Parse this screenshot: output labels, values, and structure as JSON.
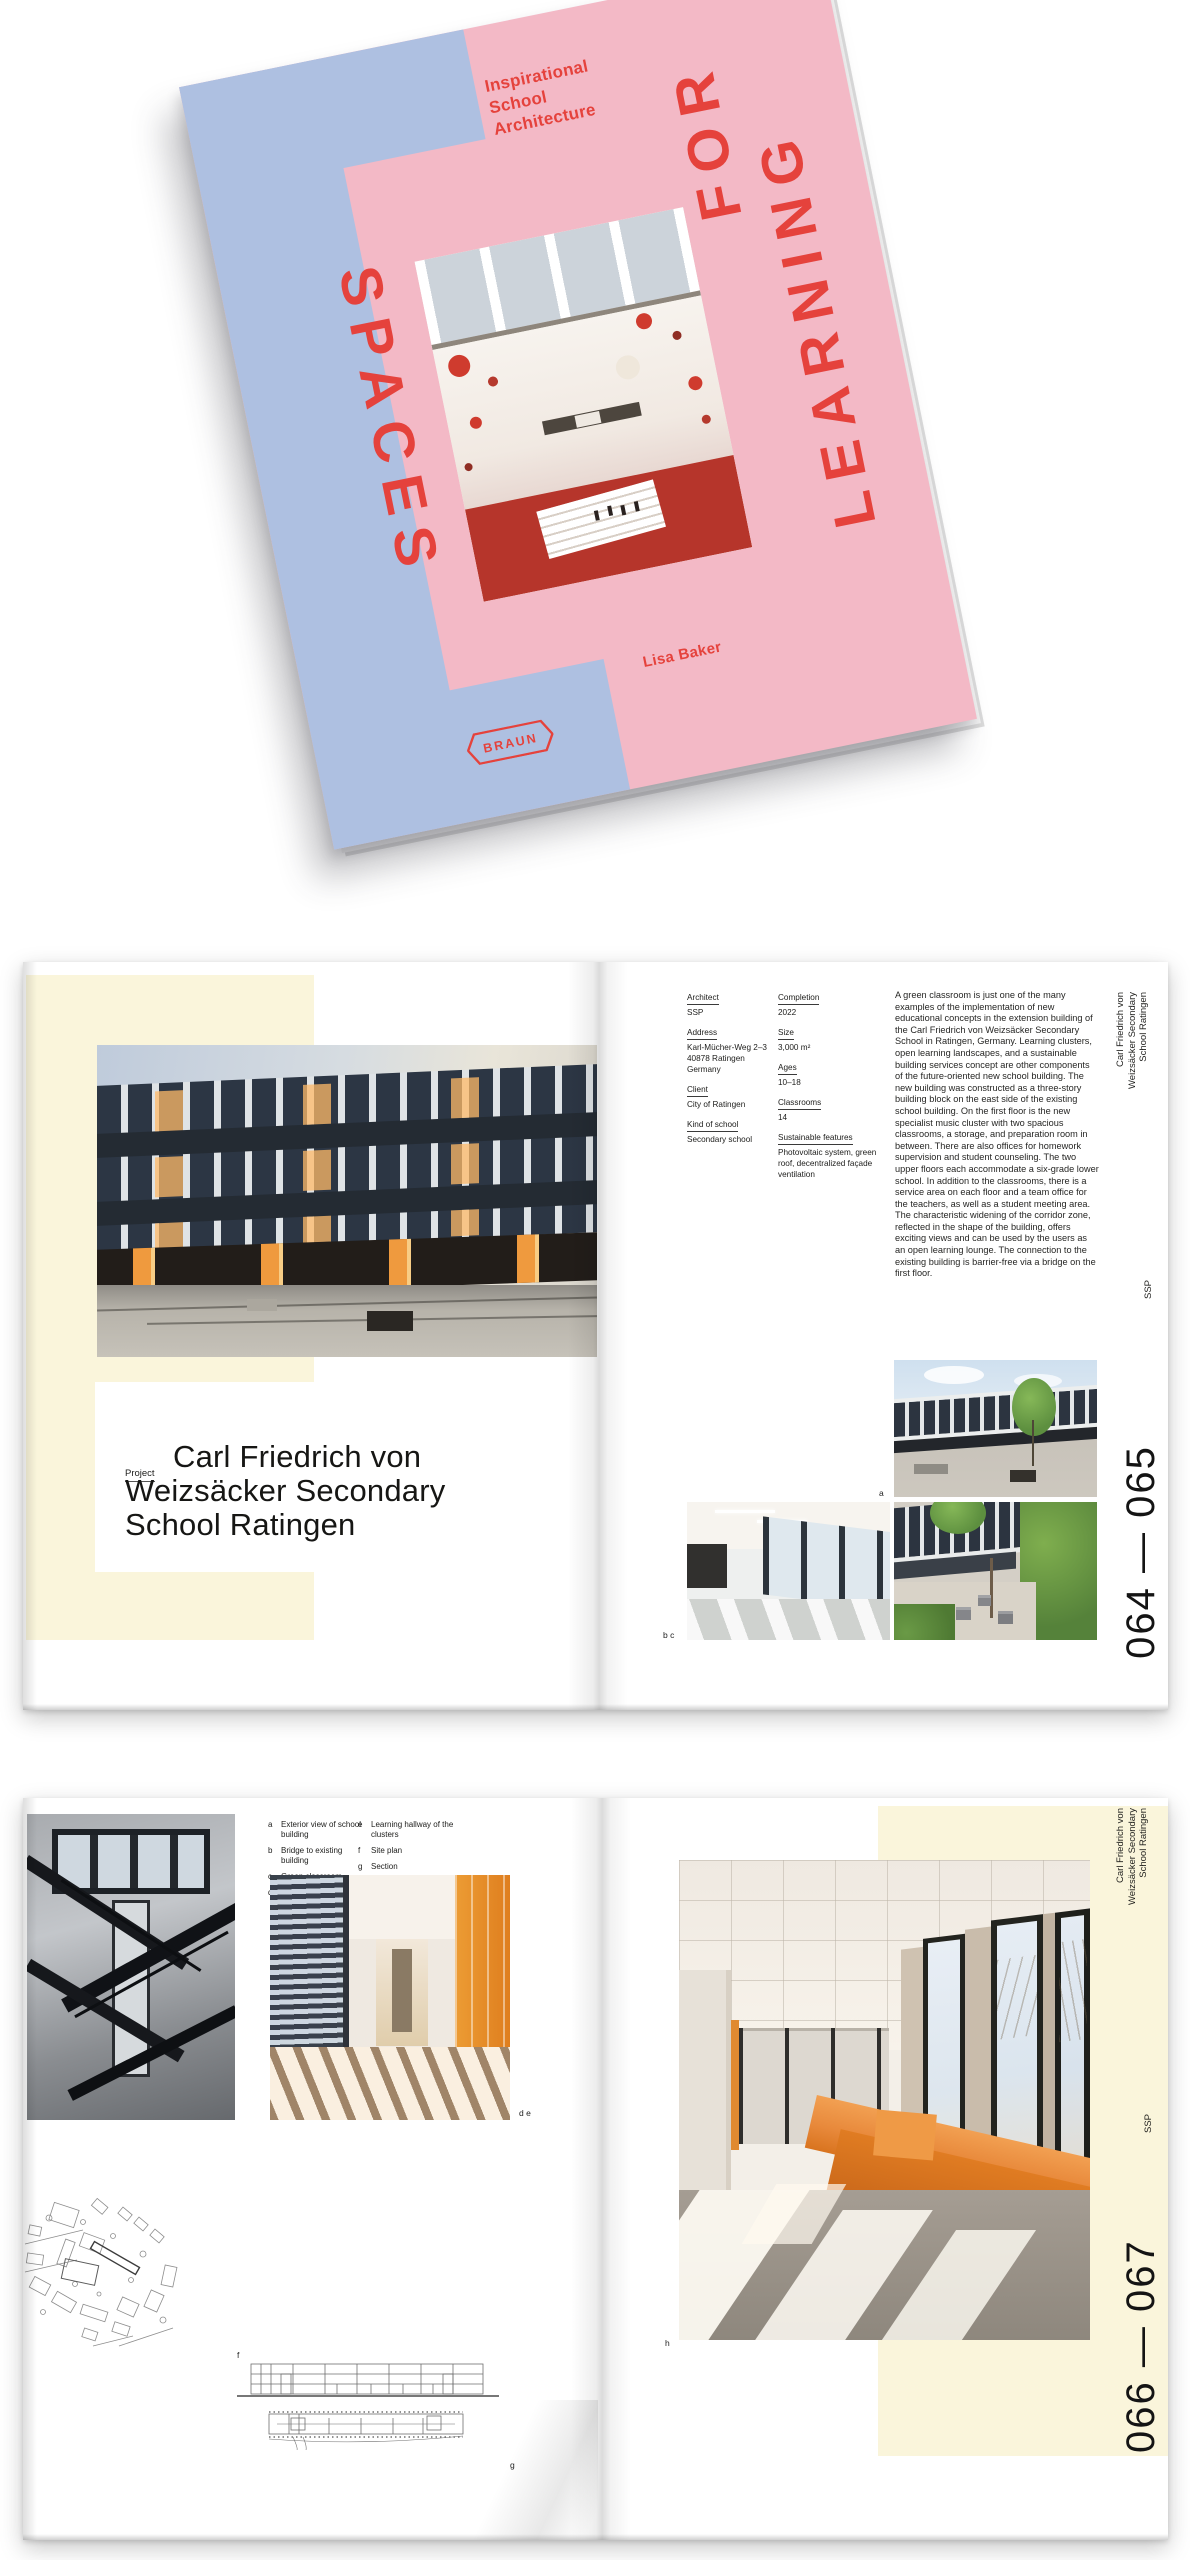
{
  "cover": {
    "tagline": "Inspirational\nSchool\nArchitecture",
    "title_word_1": "SPACES",
    "title_word_2": "FOR",
    "title_word_3": "LEARNING",
    "author": "Lisa Baker",
    "publisher": "BRAUN",
    "colors": {
      "pink": "#F3B9C6",
      "blue": "#AEC0E1",
      "red": "#E5423C",
      "cream": "#FAF5DB"
    }
  },
  "spread1": {
    "left": {
      "project_label": "Project",
      "title_line_1": "Carl Friedrich von",
      "title_line_2": "Weizsäcker Secondary",
      "title_line_3": "School Ratingen"
    },
    "right": {
      "meta_col1": [
        {
          "label": "Architect",
          "value": "SSP"
        },
        {
          "label": "Address",
          "value": "Karl-Mücher-Weg 2–3\n40878 Ratingen\nGermany"
        },
        {
          "label": "Client",
          "value": "City of Ratingen"
        },
        {
          "label": "Kind of school",
          "value": "Secondary school"
        }
      ],
      "meta_col2": [
        {
          "label": "Completion",
          "value": "2022"
        },
        {
          "label": "Size",
          "value": "3,000 m²"
        },
        {
          "label": "Ages",
          "value": "10–18"
        },
        {
          "label": "Classrooms",
          "value": "14"
        },
        {
          "label": "Sustainable features",
          "value": "Photovoltaic system, green roof, decentralized façade ventilation"
        }
      ],
      "body": "A green classroom is just one of the many examples of the implementation of new educational concepts in the extension building of the Carl Friedrich von Weizsäcker Secondary School in Ratingen, Germany. Learning clusters, open learning landscapes, and a sustainable building services concept are other components of the future-oriented new school building. The new building was constructed as a three-story building block on the east side of the existing school building. On the first floor is the new specialist music cluster with two spacious classrooms, a storage, and preparation room in between. There are also offices for homework supervision and student counseling. The two upper floors each accommodate a six-grade lower school. In addition to the classrooms, there is a service area on each floor and a team office for the teachers, as well as a student meeting area. The characteristic widening of the corridor zone, reflected in the shape of the building, offers exciting views and can be used by the users as an open learning lounge. The connection to the existing building is barrier-free via a bridge on the first floor.",
      "label_a": "a",
      "label_bc": "b c",
      "sidebar_title": "Carl Friedrich von\nWeizsäcker Secondary\nSchool Ratingen",
      "sidebar_architect": "SSP",
      "folio": "064 — 065"
    }
  },
  "spread2": {
    "captions_col1": [
      {
        "letter": "a",
        "text": "Exterior view of school\nbuilding"
      },
      {
        "letter": "b",
        "text": "Bridge to existing\nbuilding"
      },
      {
        "letter": "c",
        "text": "Green classroom"
      },
      {
        "letter": "d",
        "text": "Stairwell"
      }
    ],
    "captions_col2": [
      {
        "letter": "e",
        "text": "Learning hallway of the\nclusters"
      },
      {
        "letter": "f",
        "text": "Site plan"
      },
      {
        "letter": "g",
        "text": "Section"
      },
      {
        "letter": "h",
        "text": "Learning hallway\nwith seating area"
      }
    ],
    "label_de": "d e",
    "label_f": "f",
    "label_g": "g",
    "label_h": "h",
    "sidebar_title": "Carl Friedrich von\nWeizsäcker Secondary\nSchool Ratingen",
    "sidebar_architect": "SSP",
    "folio": "066 — 067"
  }
}
